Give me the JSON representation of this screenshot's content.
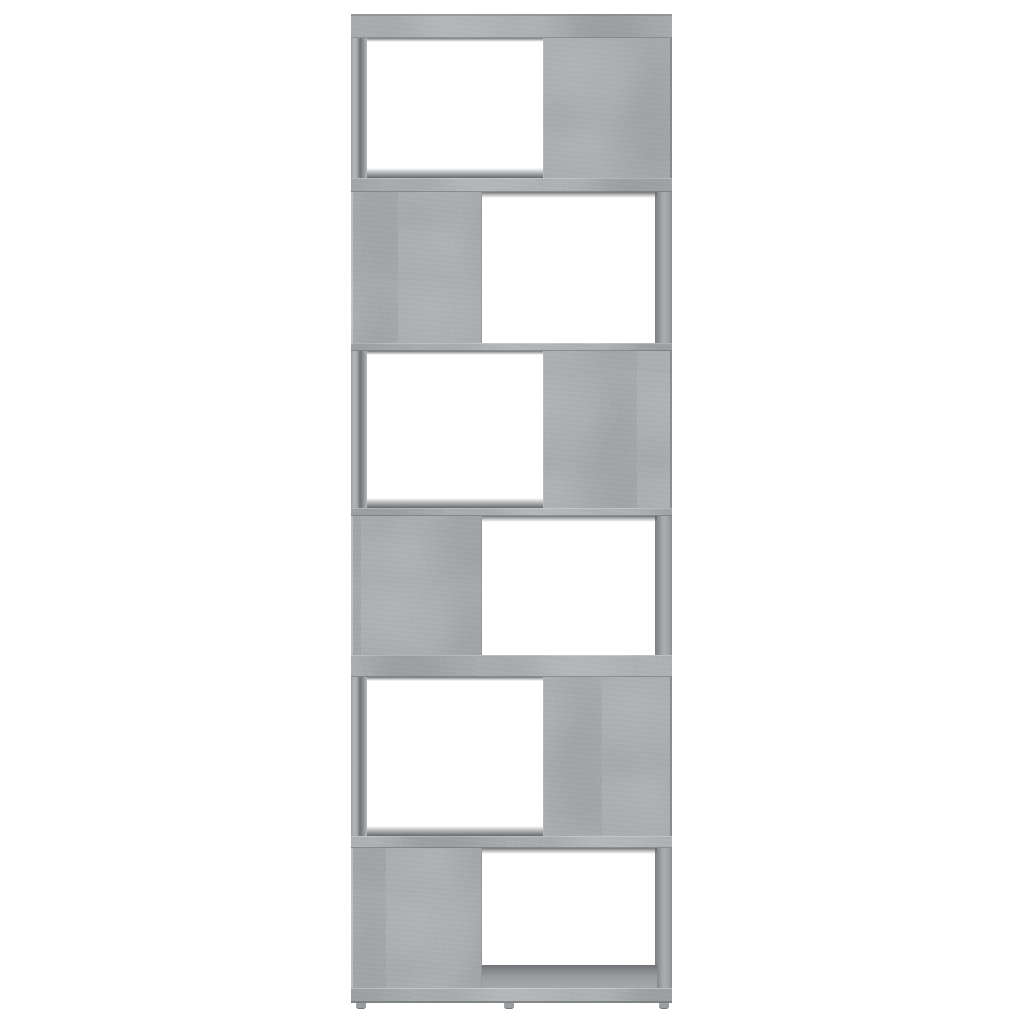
{
  "scene": {
    "type_label": "product-photo",
    "background_color": "#ffffff",
    "subject": "Book cabinet / room divider in concrete grey, zig-zag design with six staggered open compartments",
    "accessibility_label": "Concrete grey zig-zag bookcase room divider with six staggered open compartments, front view on a white background"
  },
  "shelf": {
    "finish": "concrete grey",
    "base_color": "#a8abad",
    "highlight_color": "#b6b9bb",
    "shade_color": "#989b9d",
    "edge_color": "#85888a",
    "inner_shadow_color": "#6e7174",
    "opening_color": "#ffffff",
    "background_color": "#ffffff",
    "compartment_count": 6,
    "feet_count": 3,
    "tiers": [
      {
        "index": 1,
        "open_side": "left"
      },
      {
        "index": 2,
        "open_side": "right"
      },
      {
        "index": 3,
        "open_side": "left"
      },
      {
        "index": 4,
        "open_side": "right"
      },
      {
        "index": 5,
        "open_side": "left"
      },
      {
        "index": 6,
        "open_side": "right"
      }
    ]
  }
}
